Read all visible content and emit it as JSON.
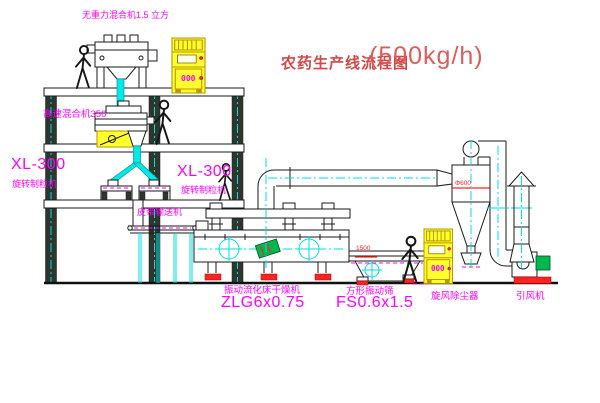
{
  "title": {
    "name": "农药生产线流程图",
    "capacity": "(500kg/h)"
  },
  "equipment": {
    "gravity_mixer": {
      "label": "无重力混合机1.5 立方"
    },
    "high_speed_mixer": {
      "label": "高速混合机350"
    },
    "granulator_left": {
      "model": "XL-300",
      "name": "旋转制粒机"
    },
    "granulator_right": {
      "model": "XL-300",
      "name": "旋转制粒机"
    },
    "belt_conveyor": {
      "label": "皮带输送机"
    },
    "fluid_bed_dryer": {
      "name": "振动流化床干燥机",
      "model": "ZLG6x0.75"
    },
    "vibrating_screen": {
      "name": "方形振动筛",
      "model": "FS0.6x1.5",
      "dimension": "1500"
    },
    "cyclone": {
      "name": "旋风除尘器",
      "dimension": "Φ600"
    },
    "fan": {
      "name": "引风机"
    },
    "control_cabinet": {
      "display": "000"
    }
  },
  "colors": {
    "label": "#ff00ff",
    "title": "#d24848",
    "centerline": "#00dede",
    "cabinet": "#ffff2e",
    "accent_red": "#ff2222",
    "motor_green": "#00b84d"
  }
}
